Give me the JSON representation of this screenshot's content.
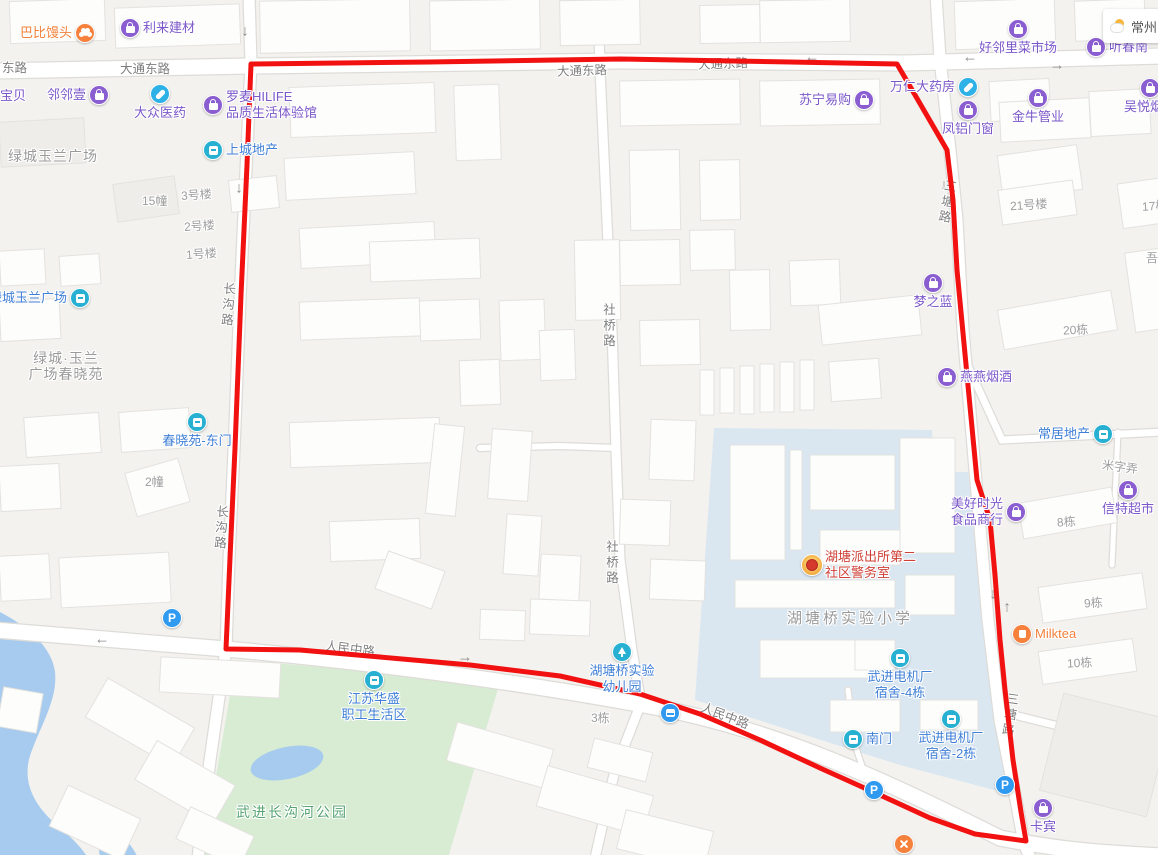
{
  "weather": {
    "city": "常州"
  },
  "overlay": {
    "color": "#f21111",
    "width": 5,
    "points": [
      [
        251,
        64
      ],
      [
        430,
        62
      ],
      [
        620,
        59
      ],
      [
        790,
        62
      ],
      [
        897,
        64
      ],
      [
        947,
        150
      ],
      [
        953,
        200
      ],
      [
        957,
        270
      ],
      [
        967,
        375
      ],
      [
        977,
        480
      ],
      [
        990,
        520
      ],
      [
        995,
        575
      ],
      [
        1000,
        640
      ],
      [
        1005,
        690
      ],
      [
        1013,
        760
      ],
      [
        1021,
        812
      ],
      [
        1026,
        841
      ],
      [
        975,
        834
      ],
      [
        930,
        818
      ],
      [
        880,
        795
      ],
      [
        820,
        768
      ],
      [
        760,
        740
      ],
      [
        700,
        714
      ],
      [
        640,
        694
      ],
      [
        560,
        676
      ],
      [
        470,
        665
      ],
      [
        380,
        657
      ],
      [
        300,
        650
      ],
      [
        226,
        649
      ],
      [
        230,
        558
      ],
      [
        235,
        448
      ],
      [
        241,
        295
      ],
      [
        247,
        165
      ],
      [
        251,
        64
      ]
    ]
  },
  "road_labels": [
    {
      "id": "donglu-w",
      "text": "东路",
      "x": 2,
      "y": 60,
      "rot": 0,
      "vertical": false
    },
    {
      "id": "datong-1",
      "text": "大通东路",
      "x": 120,
      "y": 61,
      "rot": 0,
      "vertical": false
    },
    {
      "id": "datong-2",
      "text": "大通东路",
      "x": 557,
      "y": 63,
      "rot": -2,
      "vertical": false
    },
    {
      "id": "datong-3",
      "text": "大通东路",
      "x": 698,
      "y": 56,
      "rot": -2,
      "vertical": false
    },
    {
      "id": "renmin-1",
      "text": "人民中路",
      "x": 325,
      "y": 641,
      "rot": 7,
      "vertical": false
    },
    {
      "id": "renmin-2",
      "text": "人民中路",
      "x": 700,
      "y": 708,
      "rot": 21,
      "vertical": false
    },
    {
      "id": "changgou-1",
      "text": "长沟路",
      "x": 219,
      "y": 282,
      "rot": 4,
      "vertical": true
    },
    {
      "id": "changgou-2",
      "text": "长沟路",
      "x": 212,
      "y": 505,
      "rot": 4,
      "vertical": true
    },
    {
      "id": "sheqiao-1",
      "text": "社桥路",
      "x": 600,
      "y": 303,
      "rot": 0,
      "vertical": true
    },
    {
      "id": "sheqiao-2",
      "text": "社桥路",
      "x": 603,
      "y": 540,
      "rot": 0,
      "vertical": true
    },
    {
      "id": "santang-1",
      "text": "三塘路",
      "x": 938,
      "y": 179,
      "rot": 10,
      "vertical": true
    },
    {
      "id": "santang-2",
      "text": "三塘路",
      "x": 1001,
      "y": 692,
      "rot": 8,
      "vertical": true
    }
  ],
  "building_labels": [
    {
      "text": "15幢",
      "x": 142,
      "y": 193,
      "rot": 0
    },
    {
      "text": "3号楼",
      "x": 181,
      "y": 187,
      "rot": -4
    },
    {
      "text": "2号楼",
      "x": 184,
      "y": 218,
      "rot": -4
    },
    {
      "text": "1号楼",
      "x": 186,
      "y": 246,
      "rot": -4
    },
    {
      "text": "2幢",
      "x": 145,
      "y": 474,
      "rot": 0
    },
    {
      "text": "21号楼",
      "x": 1010,
      "y": 197,
      "rot": -4
    },
    {
      "text": "17栋",
      "x": 1142,
      "y": 198,
      "rot": -4
    },
    {
      "text": "吾悦",
      "x": 1146,
      "y": 250,
      "rot": 0
    },
    {
      "text": "20栋",
      "x": 1063,
      "y": 322,
      "rot": -3
    },
    {
      "text": "米字弄",
      "x": 1102,
      "y": 459,
      "rot": 8
    },
    {
      "text": "8栋",
      "x": 1057,
      "y": 514,
      "rot": -4
    },
    {
      "text": "9栋",
      "x": 1084,
      "y": 595,
      "rot": -3
    },
    {
      "text": "10栋",
      "x": 1067,
      "y": 655,
      "rot": -3
    },
    {
      "text": "3栋",
      "x": 591,
      "y": 710,
      "rot": 0
    }
  ],
  "area_labels": [
    {
      "id": "lvcheng-plaza",
      "lines": [
        "绿城玉兰广场"
      ],
      "x": 8,
      "y": 148,
      "style": "c-graylg",
      "center": false
    },
    {
      "id": "chunxiaoyuan",
      "lines": [
        "绿城·玉兰",
        "广场春晓苑"
      ],
      "x": 66,
      "y": 350,
      "style": "c-graylg",
      "center": true
    },
    {
      "id": "hutangqiao-primary-school",
      "lines": [
        "湖塘桥实验小学"
      ],
      "x": 850,
      "y": 611,
      "style": "c-graylg",
      "center": true
    },
    {
      "id": "changgouhe-park",
      "lines": [
        "武进长沟河公园"
      ],
      "x": 292,
      "y": 804,
      "style": "c-green",
      "center": true
    }
  ],
  "pois": [
    {
      "id": "babi-mantou",
      "icon": "orange-blob",
      "style": "c-orange",
      "x": 85,
      "y": 33,
      "pos": "left",
      "lines": [
        "巴比馒头"
      ]
    },
    {
      "id": "lilai-jiancai",
      "icon": "purple-bag",
      "style": "c-purple",
      "x": 130,
      "y": 28,
      "pos": "right",
      "lines": [
        "利来建材"
      ]
    },
    {
      "id": "haolinli-market",
      "icon": "purple-bag",
      "style": "c-purple",
      "x": 1018,
      "y": 29,
      "pos": "below",
      "lines": [
        "好邻里菜市场"
      ]
    },
    {
      "id": "tingchun-partial",
      "icon": "purple-bag",
      "style": "c-purple",
      "x": 1096,
      "y": 47,
      "pos": "right",
      "lines": [
        "听春南"
      ]
    },
    {
      "id": "linlin-yi",
      "icon": "purple-bag",
      "style": "c-purple",
      "x": 99,
      "y": 95,
      "pos": "left",
      "lines": [
        "邻邻壹"
      ]
    },
    {
      "id": "baobei",
      "icon": "none",
      "style": "c-purple",
      "x": 0,
      "y": 96,
      "pos": "right",
      "lines": [
        "宝贝"
      ]
    },
    {
      "id": "dazhong-yiyao",
      "icon": "cyan-pill",
      "style": "c-purple",
      "x": 160,
      "y": 94,
      "pos": "below",
      "lines": [
        "大众医药"
      ]
    },
    {
      "id": "luomai-hilife",
      "icon": "purple-bag",
      "style": "c-purple",
      "x": 213,
      "y": 105,
      "pos": "right",
      "lines": [
        "罗麦HILIFE",
        "品质生活体验馆"
      ]
    },
    {
      "id": "shangcheng-dichan",
      "icon": "teal-door",
      "style": "c-blue",
      "x": 213,
      "y": 150,
      "pos": "right",
      "lines": [
        "上城地产"
      ]
    },
    {
      "id": "suning",
      "icon": "purple-bag",
      "style": "c-purple",
      "x": 864,
      "y": 100,
      "pos": "left",
      "lines": [
        "苏宁易购"
      ]
    },
    {
      "id": "wanren-yaofang",
      "icon": "cyan-pill",
      "style": "c-purple",
      "x": 968,
      "y": 87,
      "pos": "left",
      "lines": [
        "万仁大药房"
      ]
    },
    {
      "id": "fenglv-menchuang",
      "icon": "purple-bag",
      "style": "c-purple",
      "x": 968,
      "y": 110,
      "pos": "below",
      "lines": [
        "凤铝门窗"
      ]
    },
    {
      "id": "jinniu-guanye",
      "icon": "purple-bag",
      "style": "c-purple",
      "x": 1038,
      "y": 98,
      "pos": "below",
      "lines": [
        "金牛管业"
      ]
    },
    {
      "id": "wuyue-yanjiu",
      "icon": "purple-bag",
      "style": "c-purple",
      "x": 1150,
      "y": 88,
      "pos": "below",
      "lines": [
        "吴悦烟酒"
      ]
    },
    {
      "id": "lvcheng-plaza-gate",
      "icon": "teal-door",
      "style": "c-blue",
      "x": 80,
      "y": 298,
      "pos": "left",
      "lines": [
        "绿城玉兰广场"
      ]
    },
    {
      "id": "chunxiaoyuan-east-gate",
      "icon": "teal-door",
      "style": "c-blue",
      "x": 197,
      "y": 422,
      "pos": "below",
      "lines": [
        "春晓苑-东门"
      ]
    },
    {
      "id": "mengzhilan",
      "icon": "purple-bag",
      "style": "c-purple",
      "x": 933,
      "y": 283,
      "pos": "below",
      "lines": [
        "梦之蓝"
      ]
    },
    {
      "id": "yanyan-yanjiu",
      "icon": "purple-bag",
      "style": "c-purple",
      "x": 947,
      "y": 377,
      "pos": "right",
      "lines": [
        "燕燕烟酒"
      ]
    },
    {
      "id": "changju-dichan",
      "icon": "teal-door",
      "style": "c-blue",
      "x": 1103,
      "y": 434,
      "pos": "left",
      "lines": [
        "常居地产"
      ]
    },
    {
      "id": "meihao-shiguang",
      "icon": "purple-bag",
      "style": "c-purple",
      "x": 1016,
      "y": 512,
      "pos": "left",
      "lines": [
        "美好时光",
        "食品商行"
      ]
    },
    {
      "id": "xinte-chaoshi",
      "icon": "purple-bag",
      "style": "c-purple",
      "x": 1128,
      "y": 490,
      "pos": "below",
      "lines": [
        "信特超市"
      ]
    },
    {
      "id": "milktea",
      "icon": "orange-cup",
      "style": "c-orange",
      "x": 1022,
      "y": 634,
      "pos": "right",
      "lines": [
        "Milktea"
      ]
    },
    {
      "id": "kabin",
      "icon": "purple-bag",
      "style": "c-purple",
      "x": 1043,
      "y": 808,
      "pos": "below",
      "lines": [
        "卡宾"
      ]
    },
    {
      "id": "hutang-police-station",
      "icon": "police",
      "style": "c-red",
      "x": 812,
      "y": 565,
      "pos": "right",
      "lines": [
        "湖塘派出所第二",
        "社区警务室"
      ]
    },
    {
      "id": "jiangsu-huasheng",
      "icon": "teal-door",
      "style": "c-blue",
      "x": 374,
      "y": 680,
      "pos": "below",
      "lines": [
        "江苏华盛",
        "职工生活区"
      ]
    },
    {
      "id": "shiyan-kindergarten",
      "icon": "teal-tree",
      "style": "c-blue",
      "x": 622,
      "y": 652,
      "pos": "below",
      "lines": [
        "湖塘桥实验",
        "幼儿园"
      ]
    },
    {
      "id": "dianjichang-dorm-4",
      "icon": "teal-door",
      "style": "c-blue",
      "x": 900,
      "y": 658,
      "pos": "below",
      "lines": [
        "武进电机厂",
        "宿舍-4栋"
      ]
    },
    {
      "id": "south-gate",
      "icon": "teal-door",
      "style": "c-blue",
      "x": 853,
      "y": 739,
      "pos": "right",
      "lines": [
        "南门"
      ]
    },
    {
      "id": "dianjichang-dorm-2",
      "icon": "teal-door",
      "style": "c-blue",
      "x": 951,
      "y": 719,
      "pos": "below",
      "lines": [
        "武进电机厂",
        "宿舍-2栋"
      ]
    },
    {
      "id": "parking-1",
      "icon": "parking",
      "style": "c-blue",
      "x": 172,
      "y": 618,
      "pos": "none",
      "lines": []
    },
    {
      "id": "parking-2",
      "icon": "parking",
      "style": "c-blue",
      "x": 874,
      "y": 790,
      "pos": "none",
      "lines": []
    },
    {
      "id": "parking-3",
      "icon": "parking",
      "style": "c-blue",
      "x": 1005,
      "y": 785,
      "pos": "none",
      "lines": []
    },
    {
      "id": "bus-stop",
      "icon": "bus",
      "style": "c-blue",
      "x": 670,
      "y": 713,
      "pos": "none",
      "lines": []
    },
    {
      "id": "food-poi",
      "icon": "orange-cross",
      "style": "c-orange",
      "x": 904,
      "y": 844,
      "pos": "none",
      "lines": []
    }
  ],
  "arrows": [
    {
      "dir": "down",
      "x": 245,
      "y": 31
    },
    {
      "dir": "down",
      "x": 239,
      "y": 188
    },
    {
      "dir": "left",
      "x": 812,
      "y": 57
    },
    {
      "dir": "left",
      "x": 970,
      "y": 57
    },
    {
      "dir": "right",
      "x": 1057,
      "y": 65
    },
    {
      "dir": "down",
      "x": 944,
      "y": 185
    },
    {
      "dir": "down",
      "x": 962,
      "y": 327
    },
    {
      "dir": "left",
      "x": 102,
      "y": 639
    },
    {
      "dir": "right",
      "x": 465,
      "y": 657
    },
    {
      "dir": "down",
      "x": 993,
      "y": 594
    },
    {
      "dir": "up",
      "x": 1007,
      "y": 607
    },
    {
      "dir": "down",
      "x": 1019,
      "y": 801
    }
  ],
  "map_colors": {
    "background": "#f3f2ef",
    "road": "#ffffff",
    "road_casing": "#dedcd8",
    "water": "#a7cbee",
    "park": "#d7ecd2",
    "school_zone": "#dae7f1",
    "building": "#fdfdfc",
    "building_edge": "#e4e2df"
  }
}
